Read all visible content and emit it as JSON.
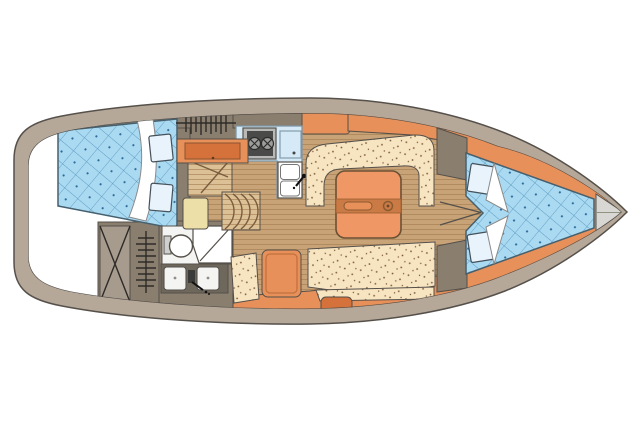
{
  "diagram": {
    "type": "sailboat-interior-floor-plan",
    "orientation": "bow-right",
    "areas": [
      {
        "id": "hull-deck",
        "label": "Hull and side decks"
      },
      {
        "id": "cockpit",
        "label": "Cockpit / lazarette area"
      },
      {
        "id": "aft-cabin-berth",
        "label": "Aft double berth"
      },
      {
        "id": "aft-hanging-locker",
        "label": "Aft hanging locker"
      },
      {
        "id": "cockpit-locker",
        "label": "Cross-hatched stowage locker"
      },
      {
        "id": "wet-hanging-locker",
        "label": "Hanging locker (port aft)"
      },
      {
        "id": "head-toilet",
        "label": "Head - toilet"
      },
      {
        "id": "head-shower",
        "label": "Head - shower"
      },
      {
        "id": "head-sinks",
        "label": "Head - twin washbasins"
      },
      {
        "id": "chart-table",
        "label": "Chart table"
      },
      {
        "id": "nav-seat",
        "label": "Navigator seat"
      },
      {
        "id": "companionway-steps",
        "label": "Companionway steps"
      },
      {
        "id": "galley-counter",
        "label": "Galley counter"
      },
      {
        "id": "galley-stove",
        "label": "Two-burner stove"
      },
      {
        "id": "galley-icebox",
        "label": "Icebox"
      },
      {
        "id": "galley-sink",
        "label": "Galley double sink"
      },
      {
        "id": "saloon-settee-top",
        "label": "Saloon wrap-around settee (starboard)"
      },
      {
        "id": "saloon-settee-bottom",
        "label": "Saloon settee (port)"
      },
      {
        "id": "saloon-seat",
        "label": "Saloon armchair"
      },
      {
        "id": "saloon-stool",
        "label": "Saloon stool"
      },
      {
        "id": "saloon-table",
        "label": "Folding saloon table"
      },
      {
        "id": "v-berth",
        "label": "Forward V-berth"
      },
      {
        "id": "anchor-locker",
        "label": "Anchor locker (bow)"
      }
    ]
  },
  "colors": {
    "page_bg": "#ffffff",
    "outline": "#55504a",
    "hull_deck": "#b5a899",
    "wall": "#8a7e6f",
    "wall_light": "#a79b8d",
    "wood": "#c8a378",
    "wood_stripe": "#ab8557",
    "wood_light": "#dcc096",
    "orange": "#e8905a",
    "orange_dark": "#d5713a",
    "table": "#ef9765",
    "table_band": "#c97a45",
    "cushion": "#f7e4c1",
    "cushion_dot": "#7b5a38",
    "berth_blue": "#aadaf2",
    "quilt_line": "#5e9ac0",
    "quilt_dot": "#2f6c99",
    "counter_blue": "#d5eaf6",
    "counter_border": "#7d96a6",
    "cream": "#ece0a8",
    "white": "#ffffff",
    "fixture": "#f4f4f2",
    "sink_counter": "#6e675c",
    "anchor_grey": "#d8d7d3",
    "stove_frame": "#b8b8b6",
    "stove_dark": "#4a4a48",
    "burner": "#9d9d9b",
    "pillow": "#e8f3fc"
  }
}
